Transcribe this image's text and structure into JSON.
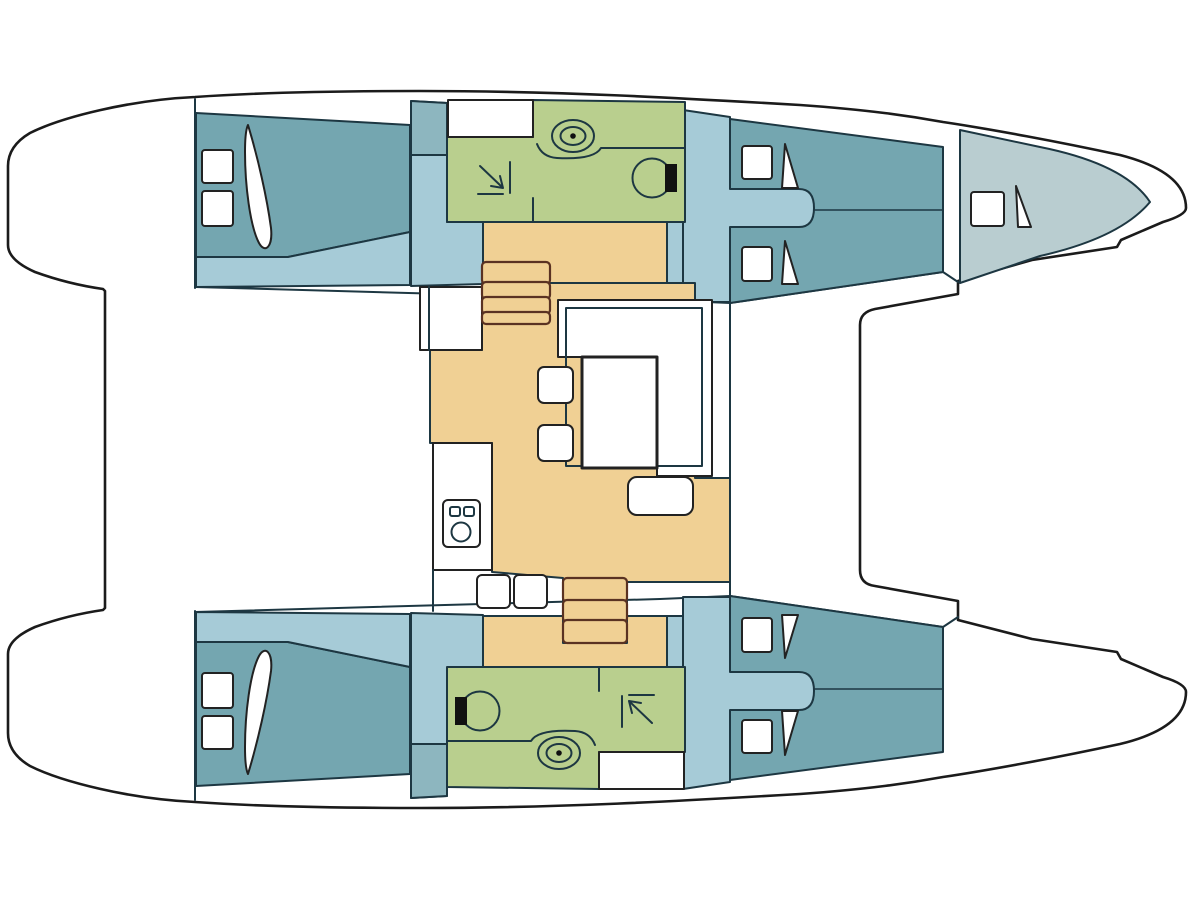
{
  "diagram": {
    "kind": "catamaran-interior-floor-plan",
    "orientation": "bows-pointing-right",
    "hulls": 2,
    "levels_shown": 1
  },
  "colors": {
    "background": "#ffffff",
    "hull_white": "#ffffff",
    "outline_stroke": "#1b1b1b",
    "wall_stroke": "#1d3742",
    "cabin_teal": "#74a6b0",
    "cabin_teal_light": "#8db6bf",
    "floor_blue": "#a6cbd7",
    "head_green": "#b9cf8e",
    "sole_beige": "#f0d094",
    "step_stroke": "#5a3222",
    "forepeak_grey": "#b9cdd0",
    "fixture_black": "#111111",
    "furniture_white": "#ffffff"
  },
  "rooms": [
    {
      "id": "aft-cabin-port",
      "fill": "cabin_teal",
      "features": [
        "double-berth",
        "2 hatches",
        "pillow"
      ]
    },
    {
      "id": "aft-cabin-starboard",
      "fill": "cabin_teal",
      "features": [
        "double-berth",
        "2 hatches",
        "pillow"
      ]
    },
    {
      "id": "head-port",
      "fill": "head_green",
      "features": [
        "sink",
        "toilet",
        "shower"
      ]
    },
    {
      "id": "head-starboard",
      "fill": "head_green",
      "features": [
        "sink",
        "toilet",
        "shower"
      ]
    },
    {
      "id": "forward-cabin-port",
      "fill": "cabin_teal",
      "features": [
        "twin-berths",
        "2 pillows"
      ]
    },
    {
      "id": "forward-cabin-starboard",
      "fill": "cabin_teal",
      "features": [
        "twin-berths",
        "2 pillows"
      ]
    },
    {
      "id": "forepeak-port",
      "fill": "forepeak_grey",
      "features": [
        "berth",
        "hatch",
        "pillow"
      ]
    },
    {
      "id": "saloon",
      "fill": "sole_beige",
      "features": [
        "table",
        "bench",
        "2 stools",
        "seat"
      ]
    },
    {
      "id": "galley",
      "fill": "furniture_white",
      "features": [
        "stove",
        "2 stools"
      ]
    },
    {
      "id": "companionway-port",
      "fill": "sole_beige",
      "features": [
        "4 steps"
      ]
    },
    {
      "id": "companionway-starboard",
      "fill": "sole_beige",
      "features": [
        "3 steps"
      ]
    }
  ],
  "fixtures": [
    "stove-icon",
    "sink-icon",
    "toilet-icon",
    "shower-arrow-icon",
    "stairs-icon",
    "pillow-icon",
    "hatch-icon"
  ]
}
